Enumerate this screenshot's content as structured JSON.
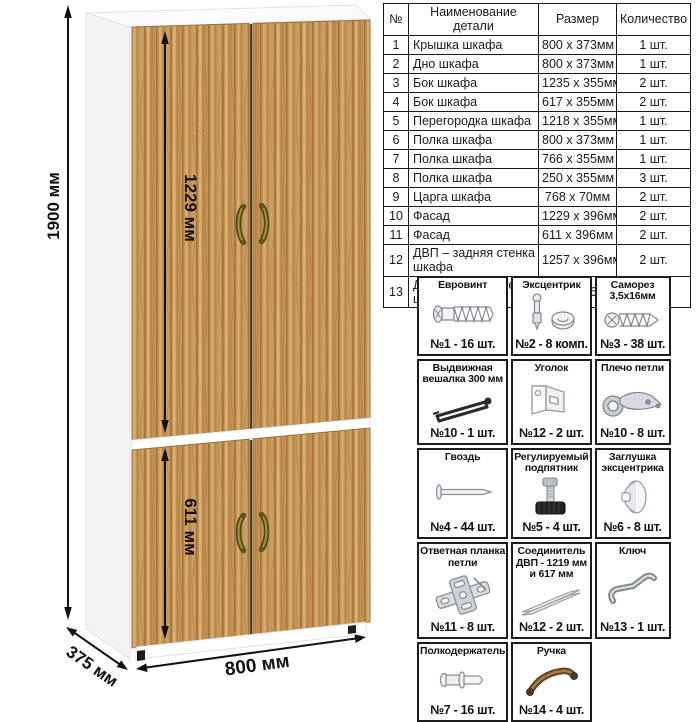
{
  "drawing": {
    "dimensions": {
      "overall_height": "1900 мм",
      "upper_door_height": "1229 мм",
      "lower_door_height": "611 мм",
      "width": "800 мм",
      "depth": "375 мм"
    },
    "colors": {
      "wood_base": "#c69556",
      "carcass_white": "#f4f4f6",
      "handle_bronze": "#8a7a35",
      "dimension_lines": "#111111"
    }
  },
  "parts_table": {
    "headers": [
      "№",
      "Наименование детали",
      "Размер",
      "Количество"
    ],
    "rows": [
      [
        "1",
        "Крышка шкафа",
        "800 x 373мм",
        "1 шт."
      ],
      [
        "2",
        "Дно шкафа",
        "800 x 373мм",
        "1 шт."
      ],
      [
        "3",
        "Бок шкафа",
        "1235 x 355мм",
        "2 шт."
      ],
      [
        "4",
        "Бок шкафа",
        "617 x 355мм",
        "2 шт."
      ],
      [
        "5",
        "Перегородка шкафа",
        "1218 x 355мм",
        "1 шт."
      ],
      [
        "6",
        "Полка шкафа",
        "800 x 373мм",
        "1 шт."
      ],
      [
        "7",
        "Полка шкафа",
        "766 x 355мм",
        "1 шт."
      ],
      [
        "8",
        "Полка шкафа",
        "250 x 355мм",
        "3 шт."
      ],
      [
        "9",
        "Царга шкафа",
        "768 x 70мм",
        "2 шт."
      ],
      [
        "10",
        "Фасад",
        "1229 x 396мм",
        "2 шт."
      ],
      [
        "11",
        "Фасад",
        "611 x 396мм",
        "2 шт."
      ],
      [
        "12",
        "ДВП – задняя стенка шкафа",
        "1257 x 396мм",
        "2 шт."
      ],
      [
        "13",
        "ДВП – задняя стенка шкафа",
        "639 x 396мм",
        "2 шт."
      ]
    ]
  },
  "hardware": {
    "items": [
      {
        "title": "Евровинт",
        "icon": "euro-screw-icon",
        "count": "№1 - 16 шт."
      },
      {
        "title": "Эксцентрик",
        "icon": "cam-lock-icon",
        "count": "№2 - 8 комп."
      },
      {
        "title": "Саморез 3,5х16мм",
        "icon": "screw-icon",
        "count": "№3 - 38 шт."
      },
      {
        "title": "Выдвижная вешалка 300 мм",
        "icon": "pullout-hanger-icon",
        "count": "№10 - 1 шт."
      },
      {
        "title": "Уголок",
        "icon": "corner-bracket-icon",
        "count": "№12 - 2 шт."
      },
      {
        "title": "Плечо петли",
        "icon": "hinge-arm-icon",
        "count": "№10 - 8 шт."
      },
      {
        "title": "Гвоздь",
        "icon": "nail-icon",
        "count": "№4 - 44 шт."
      },
      {
        "title": "Регулируемый подпятник",
        "icon": "adjustable-foot-icon",
        "count": "№5 - 4 шт."
      },
      {
        "title": "Заглушка эксцентрика",
        "icon": "cam-cover-icon",
        "count": "№6 - 8 шт."
      },
      {
        "title": "Ответная планка петли",
        "icon": "hinge-plate-icon",
        "count": "№11 - 8 шт."
      },
      {
        "title": "Соединитель ДВП - 1219 мм и 617 мм",
        "icon": "hdf-connector-icon",
        "count": "№12 - 2 шт."
      },
      {
        "title": "Ключ",
        "icon": "hex-key-icon",
        "count": "№13 - 1 шт."
      },
      {
        "title": "Полкодержатель",
        "icon": "shelf-pin-icon",
        "count": "№7 - 16 шт."
      },
      {
        "title": "Ручка",
        "icon": "handle-icon",
        "count": "№14 - 4 шт."
      }
    ]
  }
}
